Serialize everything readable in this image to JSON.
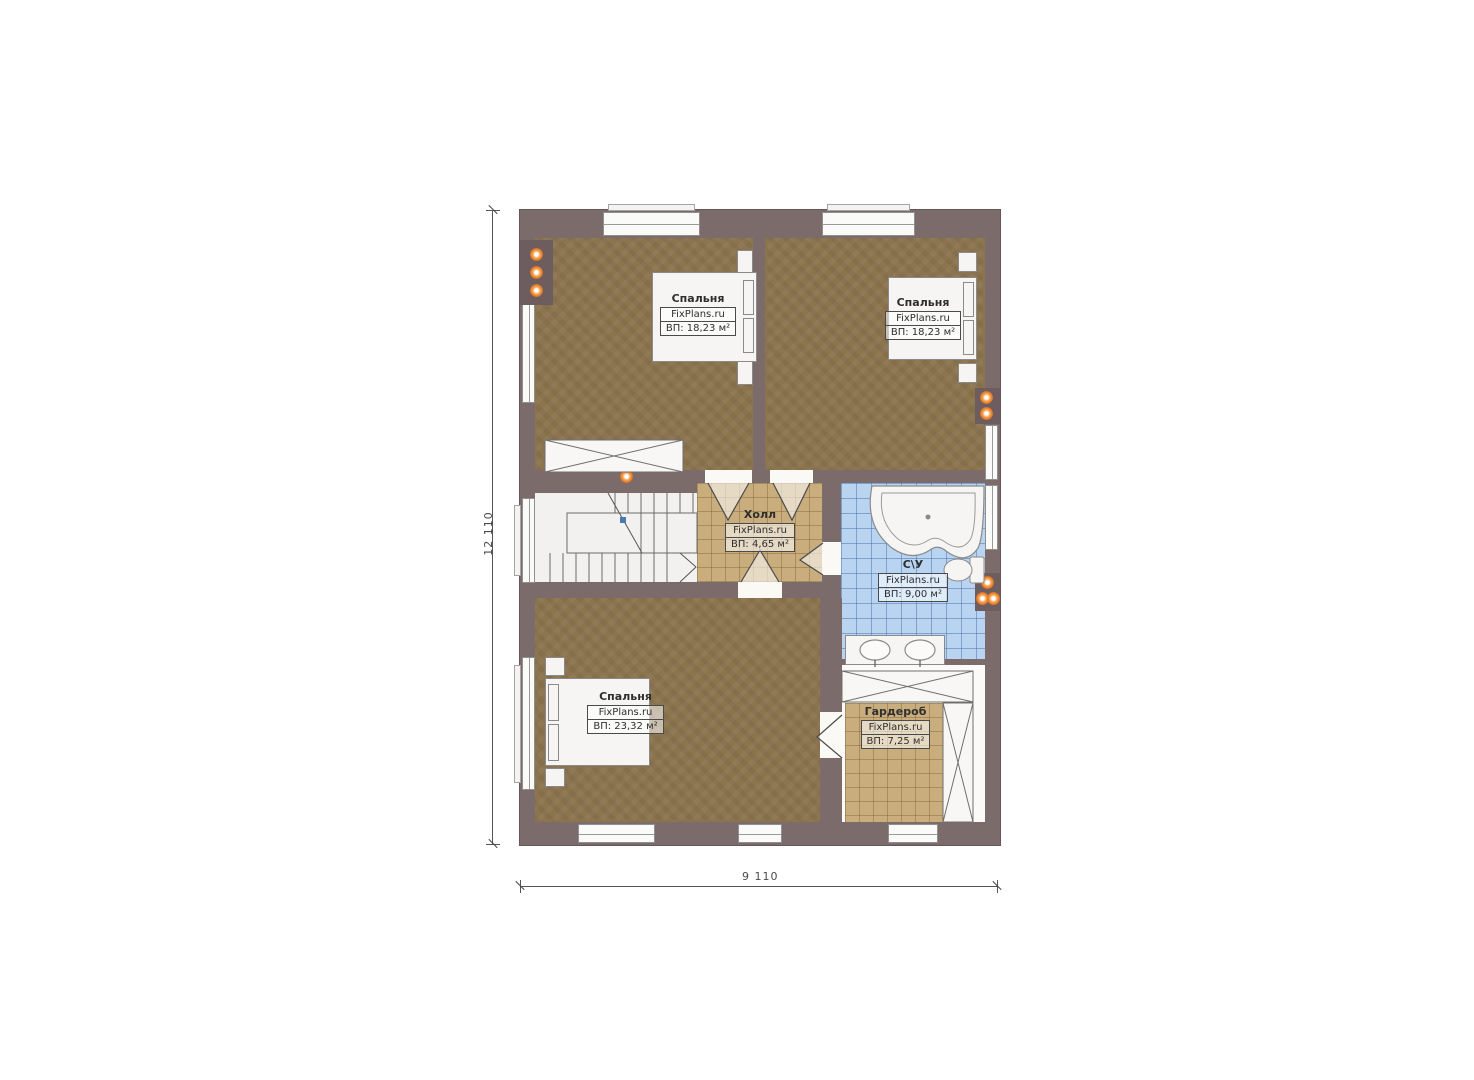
{
  "plan": {
    "brand": "FixPlans.ru",
    "dimensions": {
      "height_label": "12 110",
      "width_label": "9 110"
    },
    "rooms": {
      "bedroom_tl": {
        "name": "Спальня",
        "watermark": "FixPlans.ru",
        "area": "ВП: 18,23 м²"
      },
      "bedroom_tr": {
        "name": "Спальня",
        "watermark": "FixPlans.ru",
        "area": "ВП: 18,23 м²"
      },
      "hall": {
        "name": "Холл",
        "watermark": "FixPlans.ru",
        "area": "ВП: 4,65 м²"
      },
      "bathroom": {
        "name": "С\\У",
        "watermark": "FixPlans.ru",
        "area": "ВП: 9,00 м²"
      },
      "bedroom_b": {
        "name": "Спальня",
        "watermark": "FixPlans.ru",
        "area": "ВП: 23,32 м²"
      },
      "wardrobe": {
        "name": "Гардероб",
        "watermark": "FixPlans.ru",
        "area": "ВП: 7,25 м²"
      }
    },
    "colors": {
      "wall": "#7c6b6b",
      "bedroom_floor": "#8c744e",
      "hall_floor": "#c9ad7c",
      "bathroom_tile": "#b8d4f1",
      "marker_orange": "#e0701f",
      "fixture_white": "#f6f5f3"
    }
  }
}
